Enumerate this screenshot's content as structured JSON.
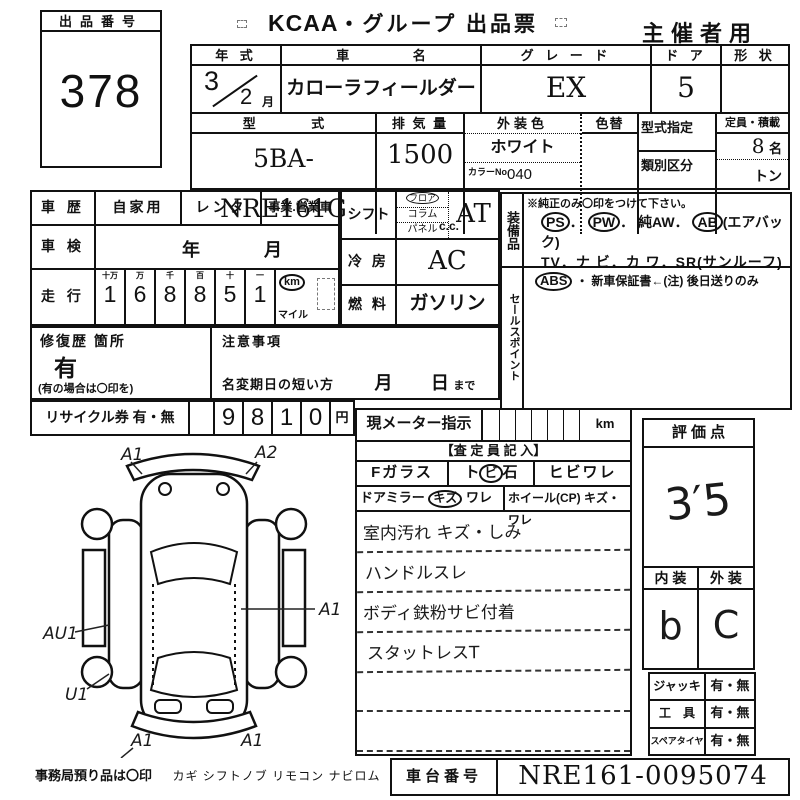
{
  "lot": {
    "label": "出品番号",
    "number": "378"
  },
  "title": {
    "logo": "KCAA",
    "rest": "・グループ 出品票",
    "audience": "主催者用"
  },
  "vehicle": {
    "year_label": "年 式",
    "year_value": "3",
    "year_month": "2",
    "month_suffix": "月",
    "name_label": "車 名",
    "name_value": "カローラフィールダー",
    "grade_label": "グ レ ー ド",
    "grade_value": "EX",
    "door_label": "ド ア",
    "door_value": "5",
    "shape_label": "形 状",
    "model_label": "型 式",
    "model_value": "5BA-NRE161G",
    "disp_label": "排 気 量",
    "disp_value": "1500",
    "disp_unit": "c.c.",
    "color_label": "外装色",
    "color_value": "ホワイト",
    "color_no_label": "カラーNo.",
    "color_no": "040",
    "repaint_label": "色替",
    "type_desig_label": "型式指定",
    "class_label": "類別区分",
    "capacity_label": "定員・積載",
    "capacity_value": "8",
    "capacity_unit": "名",
    "load_unit": "トン"
  },
  "history": {
    "label": "車 歴",
    "opt1": "自家用",
    "opt2": "レンタ",
    "opt3": "事業.営業車"
  },
  "inspection": {
    "label": "車 検",
    "year": "年",
    "month": "月"
  },
  "mileage": {
    "label": "走 行",
    "headers": [
      "十万",
      "万",
      "千",
      "百",
      "十",
      "一"
    ],
    "digits": [
      "1",
      "6",
      "8",
      "8",
      "5",
      "1"
    ],
    "km": "km",
    "mile": "マイル"
  },
  "repair": {
    "label": "修復歴 箇所",
    "value": "有",
    "note": "(有の場合は〇印を)"
  },
  "caution": {
    "label": "注意事項",
    "rename": "名変期日の短い方",
    "month": "月",
    "day": "日",
    "until": "まで"
  },
  "recycle": {
    "label": "リサイクル券 有・無",
    "digits": [
      "9",
      "8",
      "1",
      "0"
    ],
    "unit": "円"
  },
  "shift": {
    "label": "シフト",
    "pos": [
      "フロア",
      "コラム",
      "パネル"
    ],
    "value": "AT"
  },
  "aircon": {
    "label": "冷 房",
    "value": "AC"
  },
  "fuel": {
    "label": "燃 料",
    "value": "ガソリン"
  },
  "equipment": {
    "vlabel": "装備品",
    "note": "※純正のみ〇印をつけて下さい。",
    "ps": "PS",
    "dot1": "．",
    "pw": "PW",
    "dot2": "．",
    "aw": "純AW．",
    "ab": "AB",
    "ab_suffix": "(エアバック)",
    "line2": "TV．ナ ビ．カ ワ．SR(サンルーフ)",
    "abs": "ABS",
    "line3_rest": "・ 新車保証書←(注) 後日送りのみ"
  },
  "sales": {
    "vlabel": "セールスポイント"
  },
  "assessor": {
    "meter_label": "現メーター指示",
    "meter_unit": "km",
    "title": "【査 定 員 記 入】",
    "fglass": "Fガラス",
    "stone_pre": "ト",
    "stone_circ": "ビ",
    "stone_post": "石",
    "crack": "ヒビワレ",
    "mirror": "ドアミラー",
    "mirror_kizu": "キズ",
    "mirror_ware": "ワレ",
    "wheel": "ホイール(CP)",
    "wheel_dmg": "キズ・ワレ",
    "notes": [
      "室内汚れ キズ・しみ",
      "ハンドルスレ",
      "ボディ鉄粉サビ付着",
      "スタットレスT"
    ]
  },
  "evaluation": {
    "label": "評 価 点",
    "score": "3′5",
    "interior_label": "内 装",
    "exterior_label": "外 装",
    "interior": "b",
    "exterior": "C"
  },
  "accessories": {
    "jack": "ジャッキ",
    "jack_v": "有・無",
    "tool": "工　具",
    "tool_v": "有・無",
    "spare": "スペアタイヤ",
    "spare_v": "有・無"
  },
  "footer": {
    "office": "事務局預り品は〇印",
    "items": "カギ シフトノブ リモコン ナビロム",
    "vin_label": "車台番号",
    "vin": "NRE161-0095074"
  },
  "diagram": {
    "labels": [
      "A1",
      "A2",
      "A1",
      "AU1",
      "U1",
      "A1",
      "A1"
    ]
  }
}
